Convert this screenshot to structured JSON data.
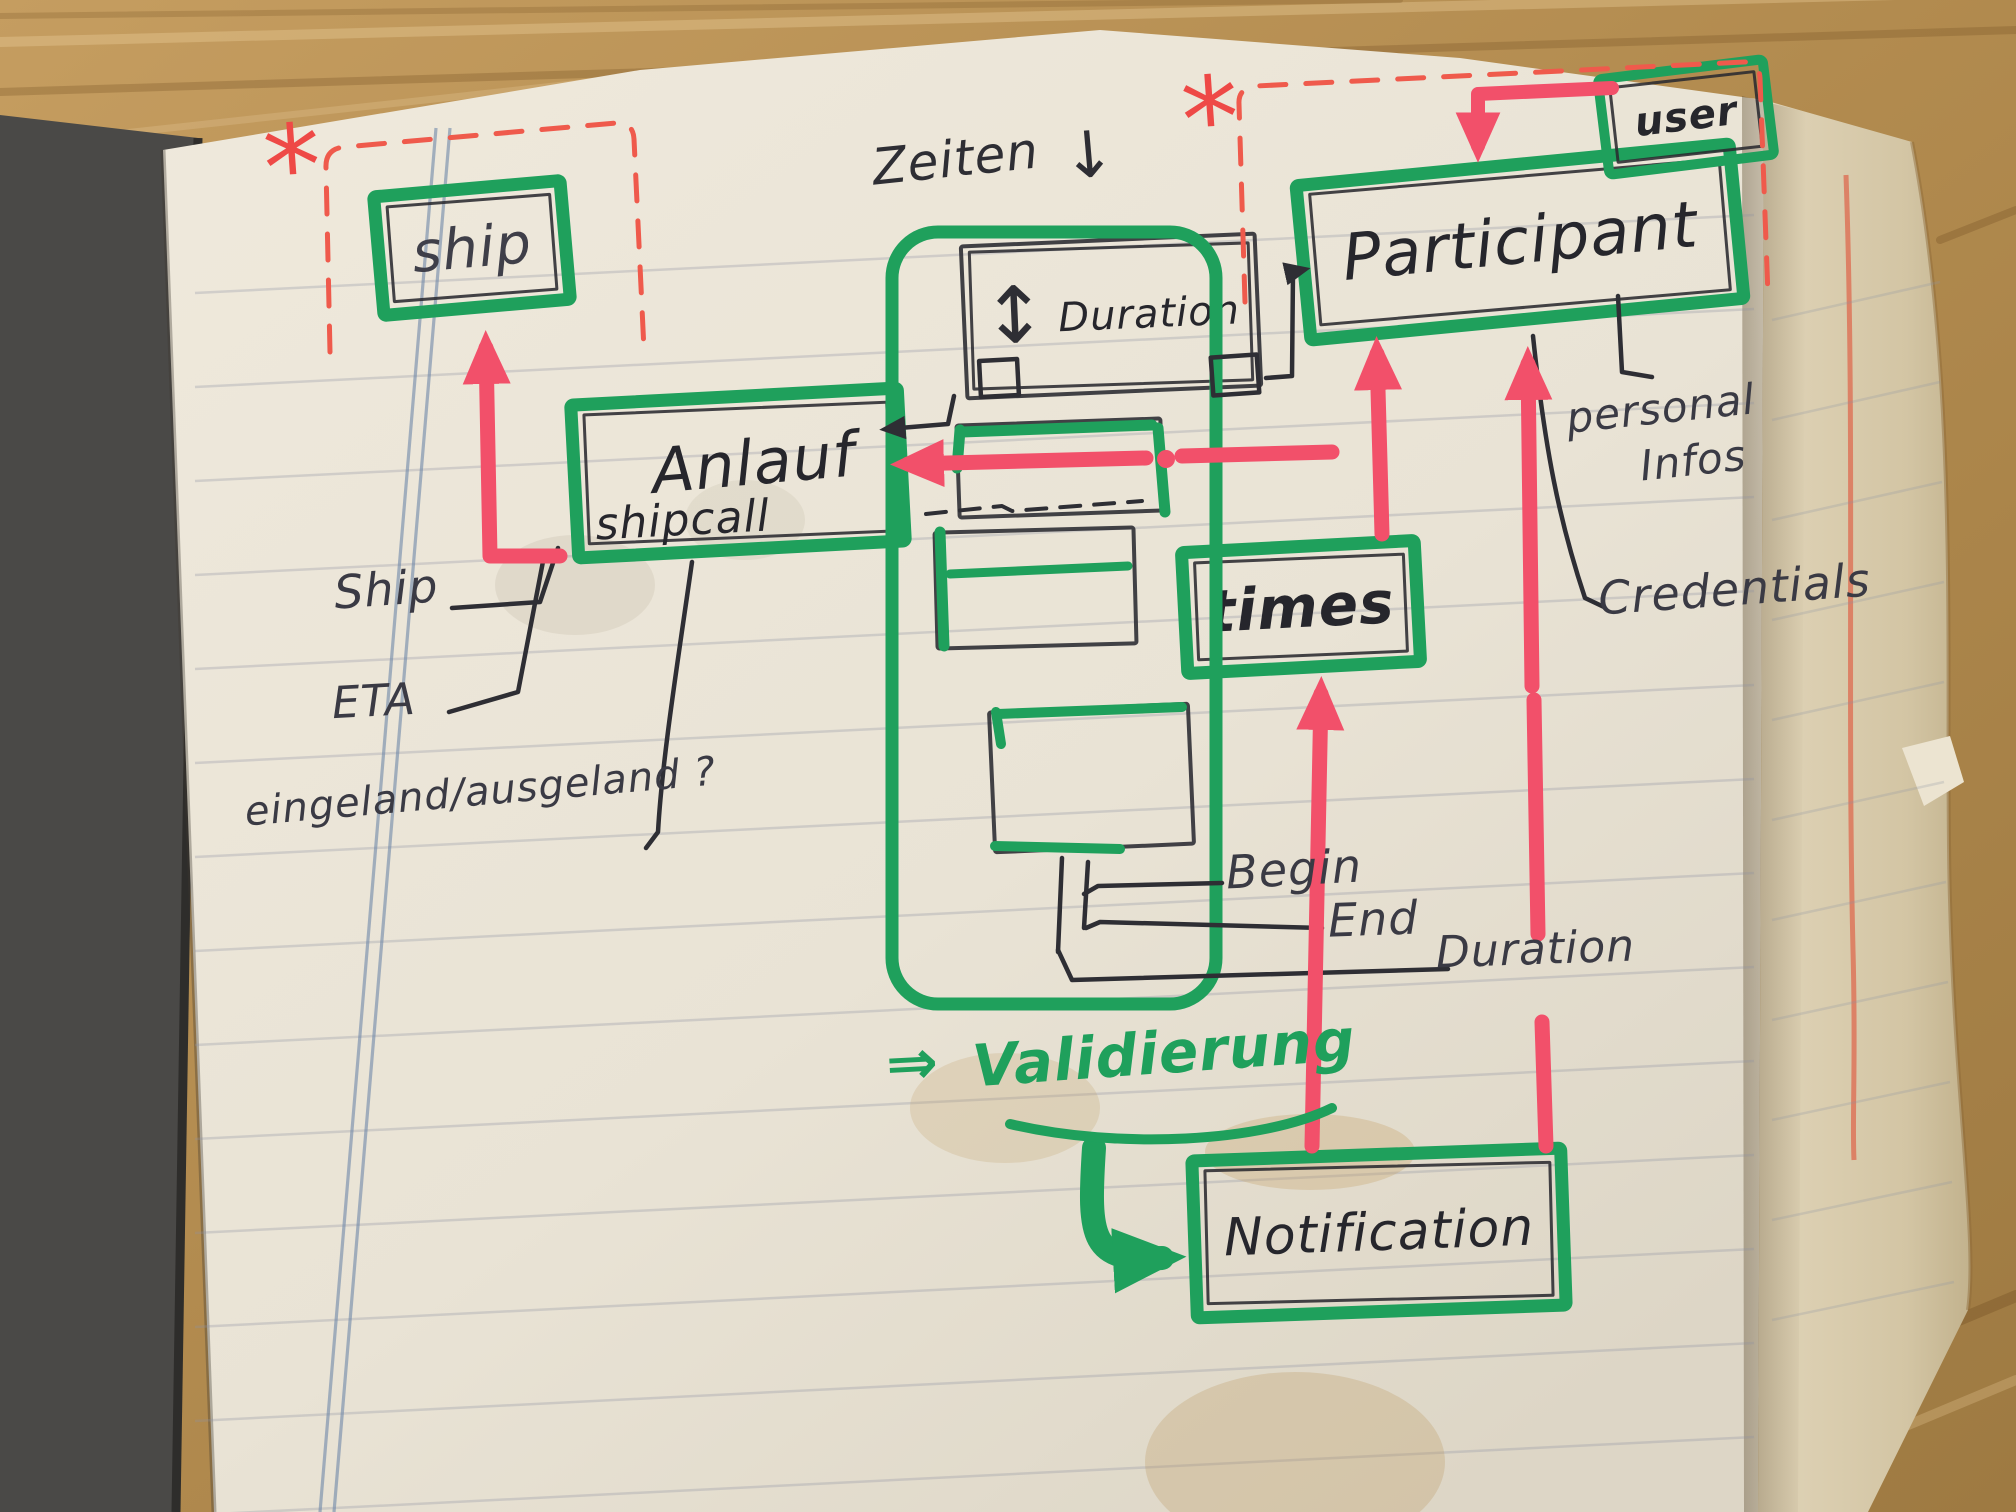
{
  "scene": {
    "type": "notebook-photo",
    "description": "Hand-drawn data-model sketch (ship call / participant / times / notification) in green and red marker on a lined notebook page lying on a wooden desk"
  },
  "colors": {
    "green_marker": "#1fa05c",
    "red_marker": "#f2506a",
    "red_dashed": "#ef5a4c",
    "ink": "#2e2e34",
    "pencil": "#3f3f49",
    "paper": "#efe9dc",
    "right_page": "#d9cbab",
    "wood": "#b48e54",
    "cover": "#4a4947",
    "blue_margin": "#6e87a8"
  },
  "boxes": {
    "ship": {
      "label": "ship"
    },
    "anlauf": {
      "label": "Anlauf",
      "sublabel": "shipcall"
    },
    "duration": {
      "icon": "↕",
      "label": "Duration"
    },
    "participant": {
      "label": "Participant"
    },
    "user": {
      "label": "user"
    },
    "times": {
      "label": "times"
    },
    "notification": {
      "label": "Notification"
    }
  },
  "labels": {
    "zeiten": "Zeiten",
    "down_arrow": "↓",
    "ship_attr": "Ship",
    "eta": "ETA",
    "inout": "eingeland/ausgeland ?",
    "begin": "Begin",
    "end": "End",
    "duration_attr": "Duration",
    "personal": "personal",
    "infos": "Infos",
    "credentials": "Credentials",
    "validation_arrow": "⇒",
    "validation": "Validierung",
    "asterisk": "*"
  }
}
